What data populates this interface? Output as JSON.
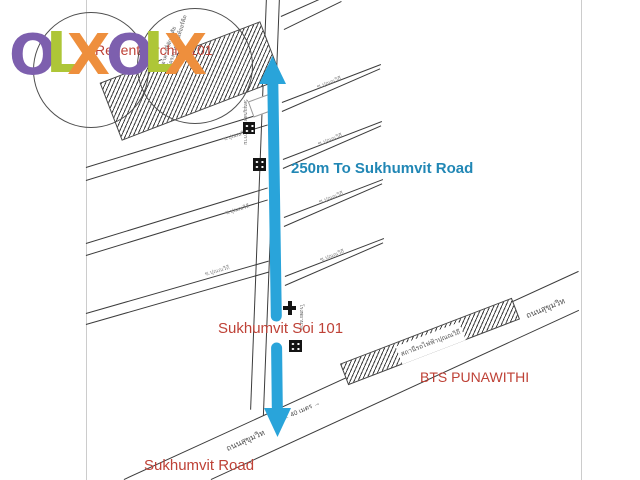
{
  "watermark": {
    "letters": [
      {
        "char": "O",
        "color": "#7d5fae"
      },
      {
        "char": "L",
        "color": "#aec637"
      },
      {
        "char": "X",
        "color": "#ee8f3d"
      }
    ]
  },
  "map": {
    "labels": {
      "regent_orchid": "Regent Orchid 101",
      "distance_note": "250m To Sukhumvit Road",
      "soi_101": "Sukhumvit Soi 101",
      "bts_station": "BTS PUNAWITHI",
      "sukhumvit_road_en": "Sukhumvit Road",
      "sukhumvit_road_th_lower": "ถนนสุขุมวิท",
      "sukhumvit_road_th_upper": "ถนนสุขุมวิท",
      "bts_station_th": "สถานีรถไฟฟ้าปุณณวิถี",
      "road_width_marker": "← 40 เมตร →",
      "hatched_building_th_line1": "อาคารที่พักอาศัย",
      "hatched_building_th_line2": "โครงการรีเจนท์ออร์คิด",
      "temple_th": "วัดบุญรอดธรรมาราม",
      "hospital_th": "โรงพยาบาล"
    },
    "side_sois": [
      {
        "label": "ซ.ปุณณวิถี"
      },
      {
        "label": "ซ.ปุณณวิถี"
      },
      {
        "label": "ซ.ปุณณวิถี"
      },
      {
        "label": "ซ.ปุณณวิถี"
      },
      {
        "label": "ซ.ปุณณวิถี"
      },
      {
        "label": "ซ.ปุณณวิถี"
      },
      {
        "label": "ซ.ปุณณวิถี"
      }
    ],
    "icons": {
      "building": "building-icon",
      "hospital": "hospital-cross-icon",
      "route_arrow": "route-double-arrow-icon"
    },
    "colors": {
      "arrow": "#29a4da",
      "red_label": "#be4136",
      "blue_label": "#2187b5",
      "road_line": "#3c3c3c",
      "border_line": "#cccccc"
    }
  }
}
